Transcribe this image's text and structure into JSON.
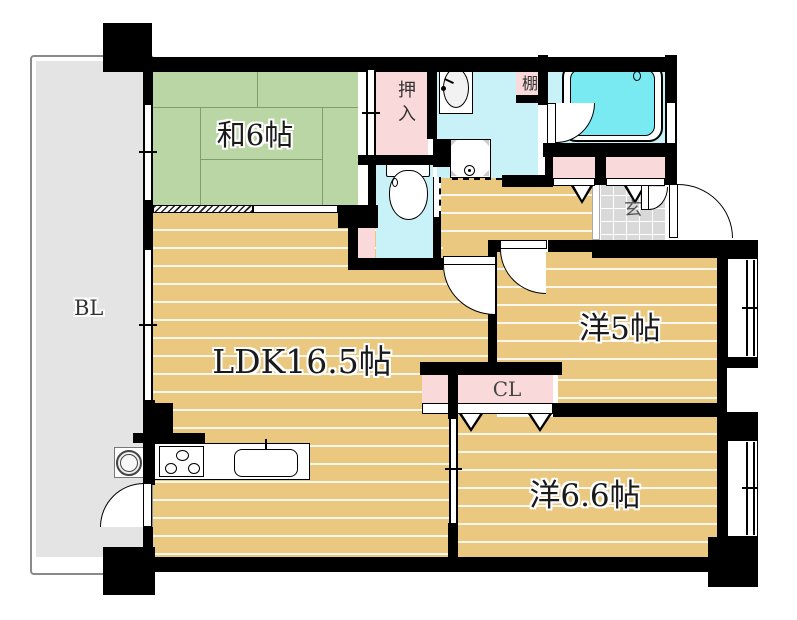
{
  "floorplan": {
    "type": "apartment-floor-plan",
    "balcony_label": "BL",
    "rooms": {
      "japanese_room": {
        "label": "和6帖",
        "type": "tatami-room"
      },
      "ldk": {
        "label": "LDK16.5帖",
        "type": "living-dining-kitchen"
      },
      "western_room_5": {
        "label": "洋5帖",
        "type": "western-room"
      },
      "western_room_66": {
        "label": "洋6.6帖",
        "type": "western-room"
      },
      "closet_cl": {
        "label": "CL",
        "type": "closet"
      },
      "oshiire": {
        "label": "押入",
        "type": "futon-closet"
      },
      "shelf": {
        "label": "棚",
        "type": "shelf"
      },
      "entrance": {
        "label": "玄",
        "type": "entrance"
      }
    },
    "fixtures": [
      "bathtub",
      "washbasin",
      "washing-machine-pan",
      "toilet",
      "kitchen-stove",
      "kitchen-sink",
      "water-heater"
    ],
    "colors": {
      "wall": "#000000",
      "tatami_green": "#b9d6a4",
      "wood_floor": "#eac87f",
      "water_rooms": "#c8f2f7",
      "bathtub_fill": "#79e9f2",
      "closet_pink": "#f9d9da",
      "balcony_gray": "#e4e4e4",
      "entrance_tile": "#d9d9d9"
    }
  }
}
